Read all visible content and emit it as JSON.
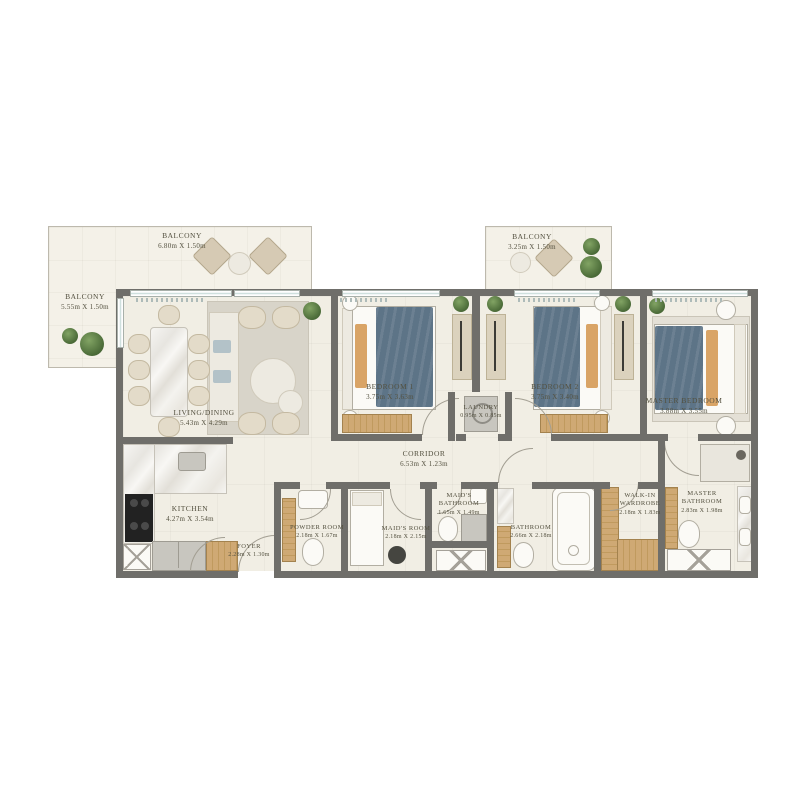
{
  "rooms": {
    "balcony_top": {
      "label": "BALCONY",
      "dims": "6.80m X 1.50m"
    },
    "balcony_left": {
      "label": "BALCONY",
      "dims": "5.55m X 1.50m"
    },
    "balcony_right": {
      "label": "BALCONY",
      "dims": "3.25m X 1.50m"
    },
    "living_dining": {
      "label": "LIVING/DINING",
      "dims": "5.43m X 4.29m"
    },
    "bedroom_1": {
      "label": "BEDROOM 1",
      "dims": "3.75m X 3.63m"
    },
    "bedroom_2": {
      "label": "BEDROOM 2",
      "dims": "3.75m X 3.40m"
    },
    "master_bedroom": {
      "label": "MASTER BEDROOM",
      "dims": "3.88m X 3.55m"
    },
    "laundry": {
      "label": "LAUNDRY",
      "dims": "0.95m X 0.85m"
    },
    "corridor": {
      "label": "CORRIDOR",
      "dims": "6.53m X 1.23m"
    },
    "kitchen": {
      "label": "KITCHEN",
      "dims": "4.27m X 3.54m"
    },
    "foyer": {
      "label": "FOYER",
      "dims": "2.28m X 1.30m"
    },
    "powder_room": {
      "label": "POWDER ROOM",
      "dims": "2.18m X 1.67m"
    },
    "maids_room": {
      "label": "MAID'S ROOM",
      "dims": "2.18m X 2.15m"
    },
    "maids_bathroom": {
      "label": "MAID'S BATHROOM",
      "dims": "1.65m X 1.49m"
    },
    "bathroom": {
      "label": "BATHROOM",
      "dims": "2.66m X 2.18m"
    },
    "walk_in_wardrobe": {
      "label": "WALK-IN WARDROBE",
      "dims": "2.18m X 1.83m"
    },
    "master_bathroom": {
      "label": "MASTER BATHROOM",
      "dims": "2.83m X 1.98m"
    }
  },
  "colors": {
    "wall": "#6f6e6a",
    "floor": "#f1eee4",
    "balcony_floor": "#f4f1e8",
    "wood": "#c9a76f",
    "bed_blanket": "#5d7487",
    "accent_pillow": "#d9a468",
    "plant": "#547041",
    "label_text": "#53503f"
  }
}
